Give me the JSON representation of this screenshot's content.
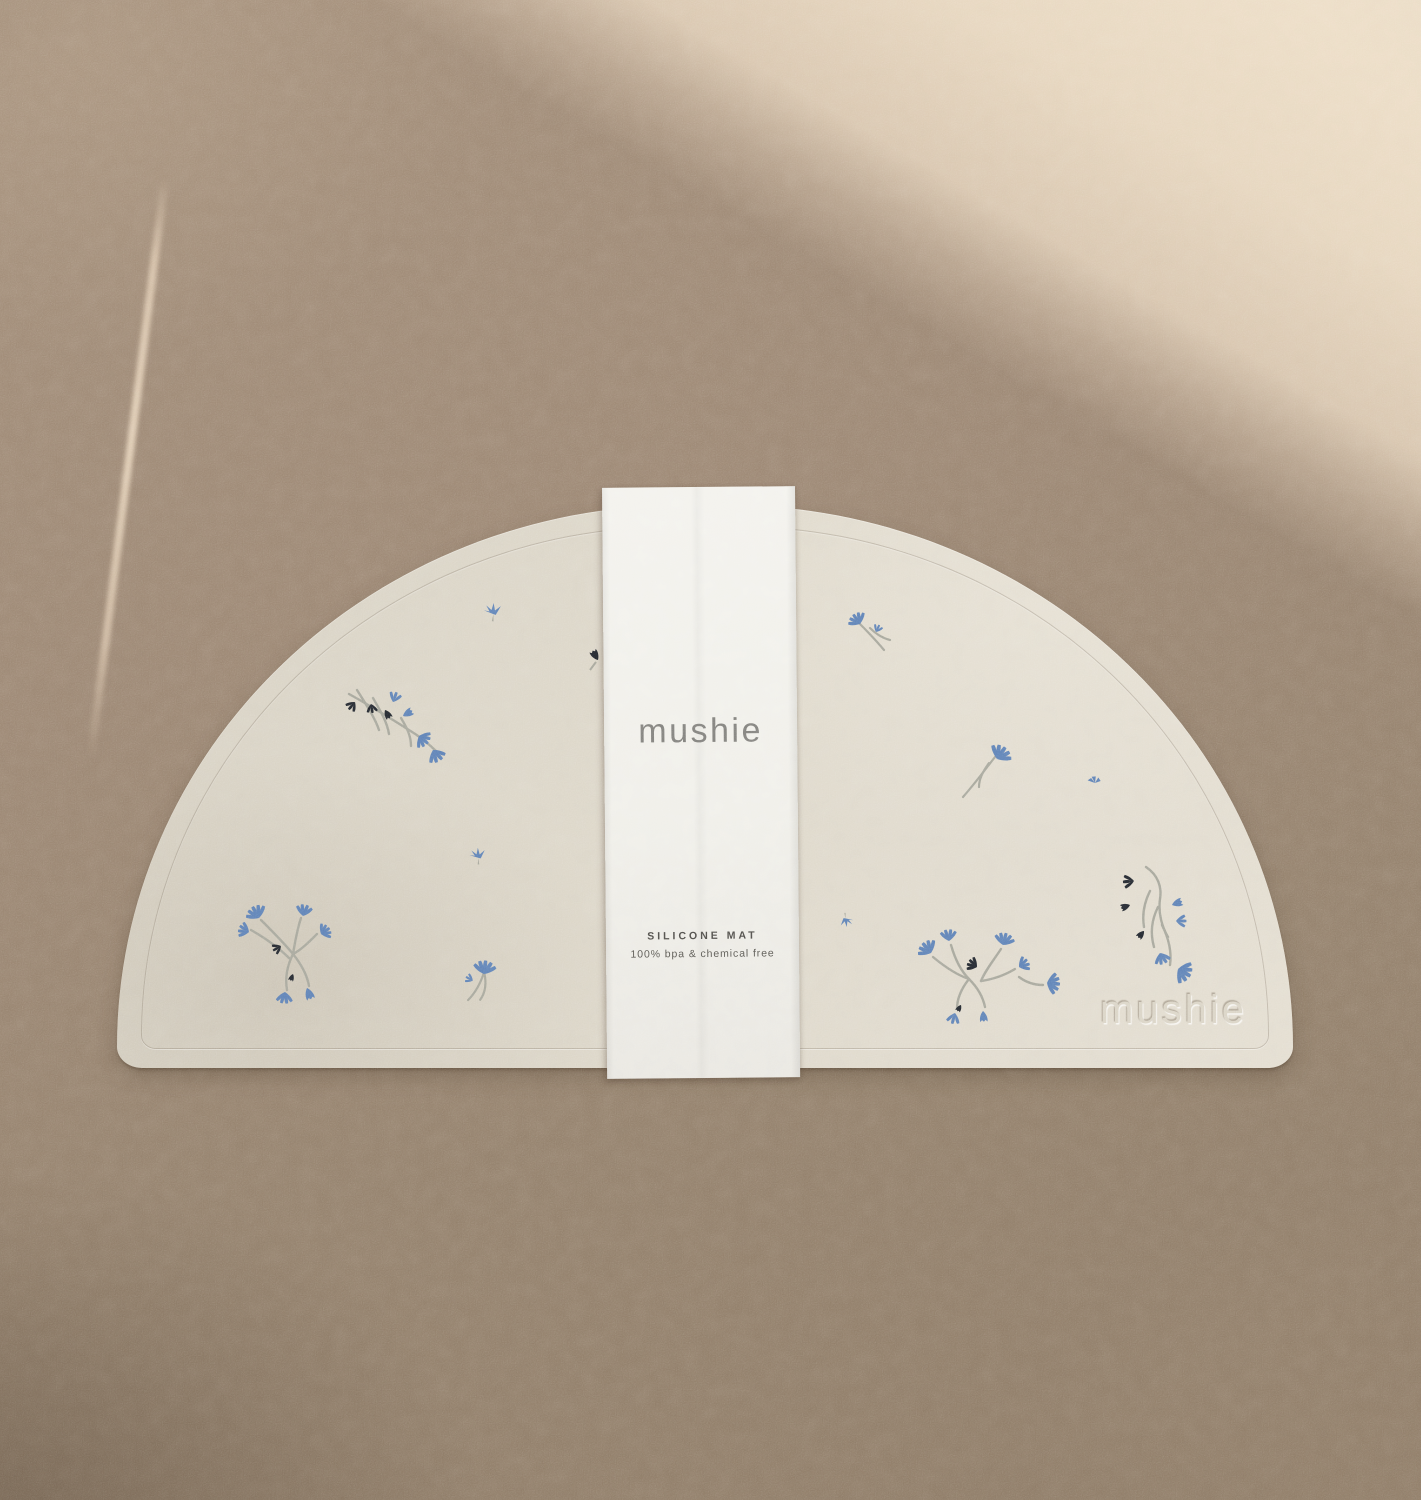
{
  "product": {
    "brand": "mushie",
    "band": {
      "brand_label": "mushie",
      "product_name": "SILICONE MAT",
      "tagline": "100% bpa & chemical free"
    },
    "mat": {
      "embossed_logo": "mushie",
      "shape": "half-moon",
      "pattern": "scattered lilac flowers"
    }
  },
  "palette": {
    "background_shadow": "#9a8571",
    "background_lit": "#e6d3bc",
    "mat_surface": "#dcd6c8",
    "band_paper": "#f0efe9",
    "flower_blue": "#5e82b6",
    "flower_dark": "#23272e",
    "stem_gray": "#a7a79c",
    "brand_text": "#82817d",
    "label_text": "#4e4c48"
  },
  "flowers": [
    {
      "type": "clusterA",
      "x": 393,
      "y": 720,
      "scale": 1,
      "rot": 0
    },
    {
      "type": "sprigTiny",
      "x": 478,
      "y": 856,
      "scale": 1,
      "rot": -15
    },
    {
      "type": "clusterB",
      "x": 295,
      "y": 948,
      "scale": 1,
      "rot": 0
    },
    {
      "type": "fanSingle",
      "x": 483,
      "y": 980,
      "scale": 1,
      "rot": 8
    },
    {
      "type": "blackPartial",
      "x": 598,
      "y": 660,
      "scale": 1,
      "rot": 0
    },
    {
      "type": "sprigTiny",
      "x": 493,
      "y": 612,
      "scale": 1.1,
      "rot": -10
    },
    {
      "type": "smallBranch",
      "x": 872,
      "y": 634,
      "scale": 1,
      "rot": 0
    },
    {
      "type": "tulipSingle",
      "x": 983,
      "y": 773,
      "scale": 1,
      "rot": 0
    },
    {
      "type": "dotPetal",
      "x": 1095,
      "y": 783,
      "scale": 1,
      "rot": -20
    },
    {
      "type": "sprigTiny",
      "x": 846,
      "y": 920,
      "scale": 0.85,
      "rot": 160
    },
    {
      "type": "clusterC",
      "x": 985,
      "y": 975,
      "scale": 1,
      "rot": 0
    },
    {
      "type": "cascade",
      "x": 1152,
      "y": 925,
      "scale": 1,
      "rot": 0
    }
  ]
}
